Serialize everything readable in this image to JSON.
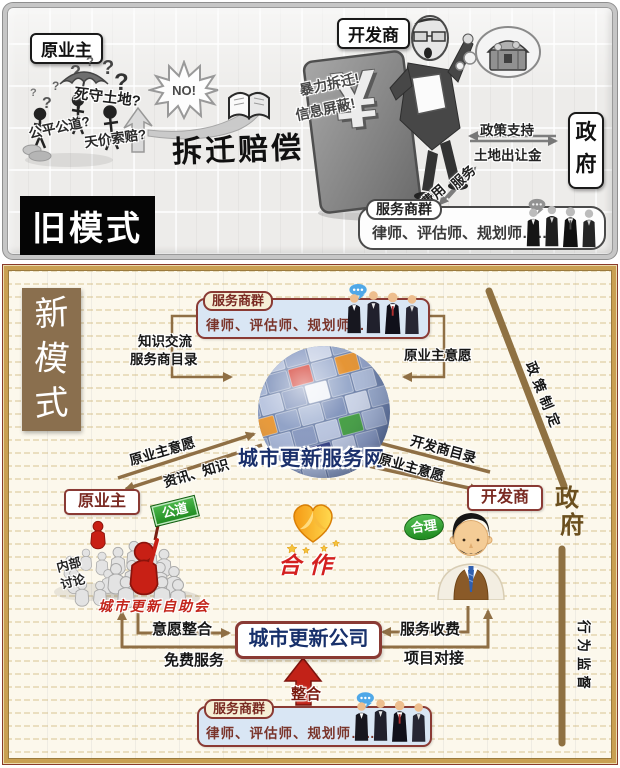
{
  "old_model": {
    "badge": "旧模式",
    "owner": {
      "label": "原业主",
      "thought_land": "死守土地?",
      "thought_fair": "公平公道?",
      "thought_price": "天价索赔?"
    },
    "refusal": "NO!",
    "title": "拆迁赔偿",
    "developer": {
      "label": "开发商",
      "yuan": "¥",
      "accuse_demolition": "暴力拆迁!",
      "accuse_info": "信息屏蔽!"
    },
    "government": {
      "char1": "政",
      "char2": "府",
      "support": "政策支持",
      "land_fee": "土地出让金"
    },
    "service_flow": {
      "service": "服务",
      "fee": "费用"
    },
    "service_group": {
      "label": "服务商群",
      "members": "律师、评估师、规划师……"
    }
  },
  "new_model": {
    "badge": {
      "char1": "新",
      "char2": "模",
      "char3": "式"
    },
    "service_group_top": {
      "label": "服务商群",
      "members": "律师、评估师、规划师……"
    },
    "links_top": {
      "knowledge": "知识交流",
      "directory": "服务商目录",
      "owner_will": "原业主意愿"
    },
    "hub": {
      "name": "城市更新服务网"
    },
    "owner_hub": {
      "up": "原业主意愿",
      "down": "资讯、知识"
    },
    "dev_hub": {
      "to_hub": "开发商目录",
      "to_dev": "原业主意愿"
    },
    "owner": {
      "label": "原业主",
      "sign": "公道",
      "talk1": "内部",
      "talk2": "讨论",
      "association": "城市更新自助会"
    },
    "cooperation": "合作",
    "developer": {
      "label": "开发商",
      "bubble": "合理"
    },
    "government": {
      "char1": "政",
      "char2": "府",
      "policy": "政策制定",
      "supervise": "行为监督"
    },
    "company": {
      "name": "城市更新公司",
      "will_in": "意愿整合",
      "free_service": "免费服务",
      "service_fee": "服务收费",
      "project_link": "项目对接",
      "integrate": "整合"
    },
    "service_group_bottom": {
      "label": "服务商群",
      "members": "律师、评估师、规划师……"
    }
  },
  "colors": {
    "maroon": "#8A3A34",
    "gold": "#C9A052",
    "brown_line": "#8F6F45",
    "red": "#C22218",
    "navy": "#1A2F6B",
    "green": "#2E8B2E",
    "badge_brown": "#8A6F4E",
    "panel_blue": "#D9E6F4"
  }
}
